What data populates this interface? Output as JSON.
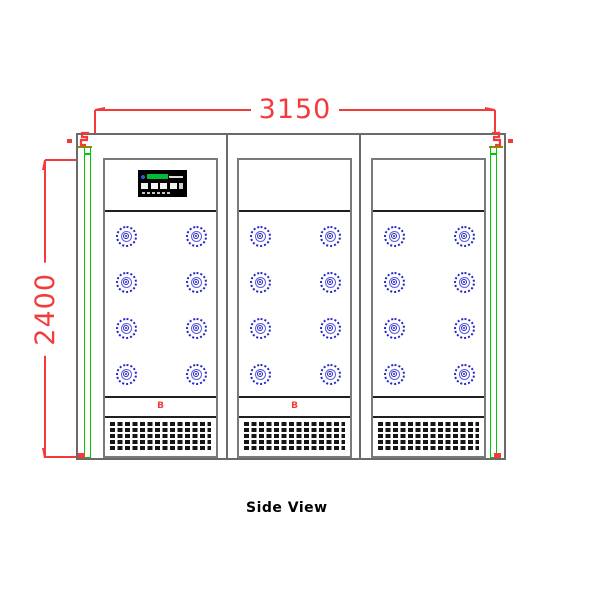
{
  "drawing": {
    "view_label": "Side View",
    "dimensions": {
      "width_label": "3150",
      "height_label": "2400"
    },
    "panels": [
      {
        "id": "panel-left",
        "b_label": "B",
        "has_display": true,
        "nozzle_rows": 4,
        "nozzle_cols": 2
      },
      {
        "id": "panel-middle",
        "b_label": "B",
        "has_display": false,
        "nozzle_rows": 4,
        "nozzle_cols": 2
      },
      {
        "id": "panel-right",
        "b_label": "",
        "has_display": false,
        "nozzle_rows": 4,
        "nozzle_cols": 2
      }
    ],
    "colors": {
      "dimension_red": "#f43b3b",
      "outline_gray": "#6a6a6a",
      "panel_gray": "#7a7a7a",
      "inner_line_black": "#1f1f1f",
      "nozzle_blue": "#2323cd",
      "nozzle_blue_mid": "#5a5ae0",
      "gasket_green": "#00c800",
      "hinge_olive": "#8b8b00",
      "display_black": "#000000",
      "display_green": "#00bb33",
      "display_blue": "#2d5ae0",
      "grille_black": "#151515"
    }
  }
}
